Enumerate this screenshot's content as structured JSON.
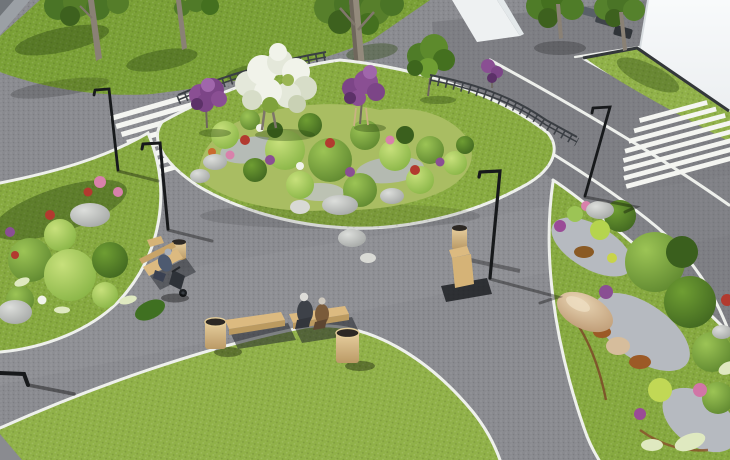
{
  "scene": {
    "title": "3D landscape-architecture visualization of a park plaza",
    "description": "Sunny aerial CGI render: curved asphalt walkways with white edge lines cross green lawns; rock-and-shrub planting beds, wooden benches with litter bins, black street lamps, metal railings, two zebra crosswalks, an asphalt road and a white building at the top right.",
    "time_of_day": "sunny daytime",
    "style": "architectural CGI render"
  },
  "palette": {
    "asphalt": "#8a8b90",
    "road_overlay": "#63656b",
    "sidewalk": "#9ba0a5",
    "edge_line": "#eef0ec",
    "crosswalk": "#f4f5f1",
    "grass": "#86a93f",
    "grass_dark": "#7aa036",
    "grass_mid": "#88ab40",
    "grass_light": "#90b148",
    "building": "#f5f7f9",
    "building_side": "#e3e8ea",
    "curb": "#33373a",
    "lamp": "#17191b",
    "railing": "#3a3e43",
    "bench_wood": "#dcba80",
    "bench_wood_dark": "#bb9a60",
    "bin_wood": "#d2b179",
    "rock": "#c6c8c4",
    "rock_tan": "#d6bd9c",
    "gravel": "#b6bac0",
    "soil": "#7a4426",
    "trunk": "#8a8175",
    "trunk_dark": "#6f675c",
    "shadow_green": "#2f4a15",
    "shadow_dark": "#22262b",
    "foliage_dark": "#44701f",
    "foliage": "#6f9e33",
    "foliage_light": "#9cc455",
    "flower_purple": "#8a4f93",
    "flower_purple_dark": "#5c3168",
    "flower_pink": "#d881ab",
    "flower_red": "#b23a2f",
    "flower_white": "#f1f3ea",
    "grass_plume": "#dfe9c0"
  },
  "objects": {
    "plaza": {
      "label": "Asphalt park paths and plaza"
    },
    "road": {
      "label": "Asphalt road with white lane markings"
    },
    "sidewalk": {
      "label": "Sidewalk corner"
    },
    "building": {
      "label": "White building facade"
    },
    "building_small": {
      "label": "White wall panel"
    },
    "lawn_top": {
      "label": "Upper lawn with tall trees"
    },
    "lawn_island": {
      "label": "Central lawn island"
    },
    "lawn_left": {
      "label": "Left lawn with rockery bed"
    },
    "lawn_circle": {
      "label": "Large oval lawn"
    },
    "lawn_right": {
      "label": "Right lawn with gravel bed"
    },
    "lawn_verge": {
      "label": "Roadside grass verge"
    },
    "crosswalk_left": {
      "label": "Zebra crosswalk on park path",
      "stripe_count": 8
    },
    "crosswalk_right": {
      "label": "Zebra crosswalk on road",
      "stripe_count": 8
    },
    "railing_left": {
      "label": "Metal railing along upper path"
    },
    "railing_right": {
      "label": "Metal railing near road"
    },
    "beds": {
      "central": {
        "label": "Central planting bed with shrubs, flowers and boulders"
      },
      "left": {
        "label": "Left rockery planting bed"
      },
      "right": {
        "label": "Right gravel planting bed with conifers and ornamental grasses"
      }
    },
    "trees": {
      "white_flowering": {
        "label": "White flowering tree"
      },
      "purple_left": {
        "label": "Purple flowering tree"
      },
      "purple_right": {
        "label": "Purple flowering tree with support stakes"
      },
      "green_island": {
        "label": "Green ornamental tree"
      },
      "trunks": {
        "label": "Tall park trees"
      }
    },
    "lamps": [
      {
        "label": "Street lamp at left crosswalk"
      },
      {
        "label": "Street lamp on left lawn edge"
      },
      {
        "label": "Street lamp at central path fork"
      },
      {
        "label": "Street lamp at road crosswalk"
      },
      {
        "label": "Street lamp arm at lower-left edge"
      }
    ],
    "benches": [
      {
        "label": "Bench with seated visitor and stroller"
      },
      {
        "label": "Empty wooden bench"
      },
      {
        "label": "Wooden bench with elderly couple"
      },
      {
        "label": "Wooden bench at path fork"
      }
    ],
    "bins": [
      {
        "label": "Wooden litter bin"
      },
      {
        "label": "Wooden litter bin"
      },
      {
        "label": "Wooden litter bin"
      },
      {
        "label": "Wooden litter bin"
      }
    ],
    "people": [
      {
        "label": "Person seated on bench",
        "clothing": "#4d5a70"
      },
      {
        "label": "Elderly man in dark jacket",
        "clothing": "#3d4148"
      },
      {
        "label": "Elderly woman in brown coat",
        "clothing": "#7a5b3a"
      }
    ],
    "vehicles": {
      "label": "Parked cars in the distance"
    },
    "rocks": {
      "label": "Decorative boulders"
    }
  }
}
